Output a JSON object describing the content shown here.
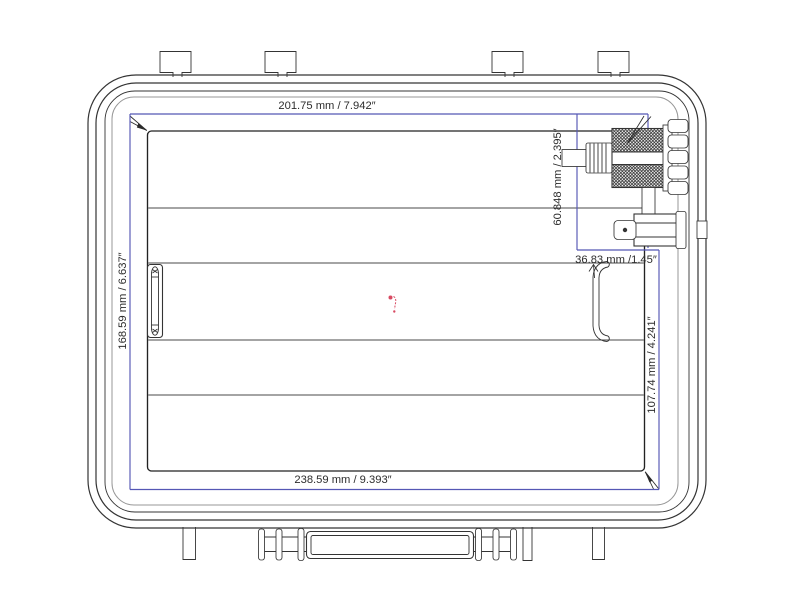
{
  "drawing": {
    "description": "technical top view drawing of a waterproof hard case with hole saw arbor tool and dimension annotations",
    "colors": {
      "bg": "#ffffff",
      "line_color": "#343434",
      "soft_line_color": "#979797",
      "inner_line_color": "#4a4a4a",
      "dim_color": "#5557b5",
      "text_color": "#2d2d2d",
      "marker_color": "#d84a62"
    },
    "dimensions": {
      "inner_width_top": "201.75 mm / 7.942″",
      "inner_height_left": "168.59 mm / 6.637″",
      "tool_height": "60.848 mm / 2.395″",
      "tool_width": "36.83 mm /1.45″",
      "pocket_height_right": "107.74 mm / 4.241″",
      "outer_width_bottom": "238.59 mm / 9.393″"
    }
  }
}
